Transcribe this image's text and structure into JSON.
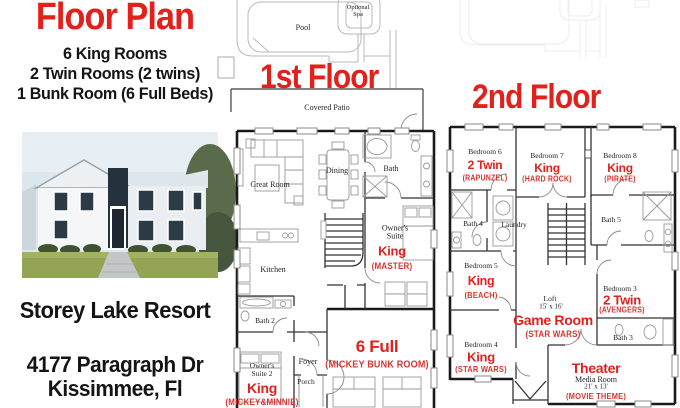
{
  "colors": {
    "accent_red": "#e2211c",
    "label_red": "#d63531"
  },
  "left_panel": {
    "title": "Floor Plan",
    "summary_lines": [
      "6 King Rooms",
      "2 Twin Rooms (2 twins)",
      "1 Bunk Room (6 Full Beds)"
    ],
    "photo": "white-two-story-house-exterior",
    "resort": "Storey Lake Resort",
    "address_line1": "4177 Paragraph Dr",
    "address_line2": "Kissimmee, Fl"
  },
  "floor1": {
    "title": "1st Floor",
    "pool": "Pool",
    "spa": "Optional Spa",
    "patio": "Covered Patio",
    "great_room": "Great Room",
    "dining": "Dining",
    "bath": "Bath",
    "kitchen": "Kitchen",
    "bath2": "Bath 2",
    "foyer": "Foyer",
    "porch": "Porch",
    "owners_suite": {
      "name": "Owner's Suite",
      "bed": "King",
      "theme": "(MASTER)"
    },
    "owners_suite2": {
      "name": "Owner's Suite 2",
      "bed": "King",
      "theme": "(MICKEY&MINNIE)"
    },
    "bunk_room": {
      "bed": "6 Full",
      "theme": "(MICKEY BUNK ROOM)"
    }
  },
  "floor2": {
    "title": "2nd Floor",
    "bedroom6": {
      "name": "Bedroom 6",
      "bed": "2 Twin",
      "theme": "(RAPUNZEL)"
    },
    "bedroom7": {
      "name": "Bedroom 7",
      "bed": "King",
      "theme": "(HARD ROCK)"
    },
    "bedroom8": {
      "name": "Bedroom 8",
      "bed": "King",
      "theme": "(PIRATE)"
    },
    "bath4": "Bath 4",
    "laundry": "Laundry",
    "bath5": "Bath 5",
    "bedroom5": {
      "name": "Bedroom 5",
      "bed": "King",
      "theme": "(BEACH)"
    },
    "loft": {
      "name": "Loft",
      "size": "15' x 16'",
      "bed": "Game Room",
      "theme": "(STAR WARS)"
    },
    "bedroom3": {
      "name": "Bedroom 3",
      "bed": "2 Twin",
      "theme": "(AVENGERS)"
    },
    "bath3": "Bath 3",
    "bedroom4": {
      "name": "Bedroom 4",
      "bed": "King",
      "theme": "(STAR WARS)"
    },
    "theater": {
      "bed": "Theater",
      "name": "Media Room",
      "size": "21' x 13'",
      "theme": "(MOVIE THEME)"
    }
  }
}
